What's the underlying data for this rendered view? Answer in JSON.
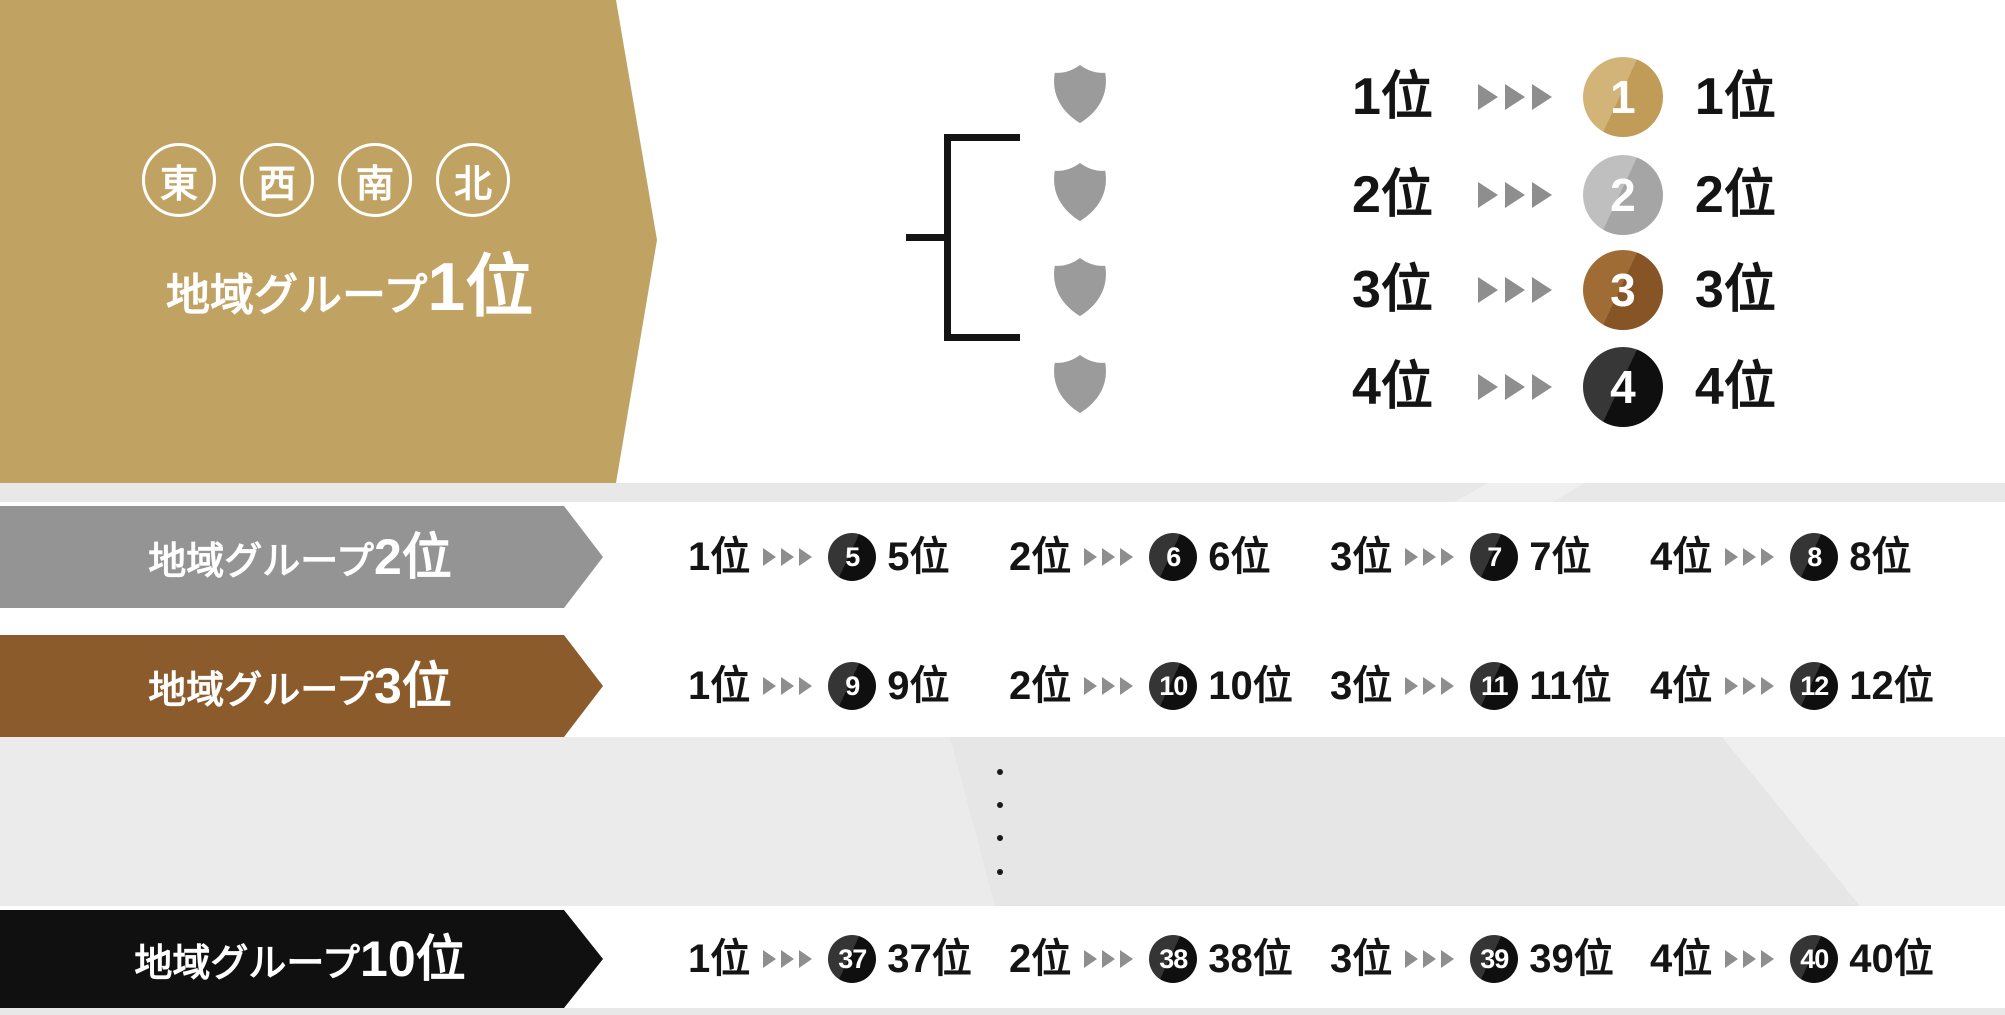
{
  "palette": {
    "gold_banner": "#C0A263",
    "gray_banner": "#949494",
    "bronze_banner": "#8B5B2C",
    "black_banner": "#101010",
    "arrow_gray": "#8E8E8E",
    "shield_gray": "#9B9B9B",
    "background_band_gray": "#E6E6E6",
    "medal_gold": "#C19B58",
    "medal_silver": "#A5A5A5",
    "medal_bronze": "#875425",
    "medal_black": "#0F0F0F"
  },
  "top_section": {
    "regions": [
      "東",
      "西",
      "南",
      "北"
    ],
    "title_prefix": "地域グループ",
    "title_rank": "1位",
    "results": [
      {
        "group_rank": "1位",
        "overall_number": "1",
        "overall_rank": "1位",
        "medal": "gold"
      },
      {
        "group_rank": "2位",
        "overall_number": "2",
        "overall_rank": "2位",
        "medal": "silver"
      },
      {
        "group_rank": "3位",
        "overall_number": "3",
        "overall_rank": "3位",
        "medal": "bronze"
      },
      {
        "group_rank": "4位",
        "overall_number": "4",
        "overall_rank": "4位",
        "medal": "black"
      }
    ]
  },
  "group_rows": [
    {
      "banner_prefix": "地域グループ",
      "banner_rank": "2位",
      "items": [
        {
          "group_rank": "1位",
          "overall_number": "5",
          "overall_rank": "5位"
        },
        {
          "group_rank": "2位",
          "overall_number": "6",
          "overall_rank": "6位"
        },
        {
          "group_rank": "3位",
          "overall_number": "7",
          "overall_rank": "7位"
        },
        {
          "group_rank": "4位",
          "overall_number": "8",
          "overall_rank": "8位"
        }
      ]
    },
    {
      "banner_prefix": "地域グループ",
      "banner_rank": "3位",
      "items": [
        {
          "group_rank": "1位",
          "overall_number": "9",
          "overall_rank": "9位"
        },
        {
          "group_rank": "2位",
          "overall_number": "10",
          "overall_rank": "10位"
        },
        {
          "group_rank": "3位",
          "overall_number": "11",
          "overall_rank": "11位"
        },
        {
          "group_rank": "4位",
          "overall_number": "12",
          "overall_rank": "12位"
        }
      ]
    },
    {
      "banner_prefix": "地域グループ",
      "banner_rank": "10位",
      "items": [
        {
          "group_rank": "1位",
          "overall_number": "37",
          "overall_rank": "37位"
        },
        {
          "group_rank": "2位",
          "overall_number": "38",
          "overall_rank": "38位"
        },
        {
          "group_rank": "3位",
          "overall_number": "39",
          "overall_rank": "39位"
        },
        {
          "group_rank": "4位",
          "overall_number": "40",
          "overall_rank": "40位"
        }
      ]
    }
  ],
  "ellipsis": {
    "dot_count": 4
  }
}
